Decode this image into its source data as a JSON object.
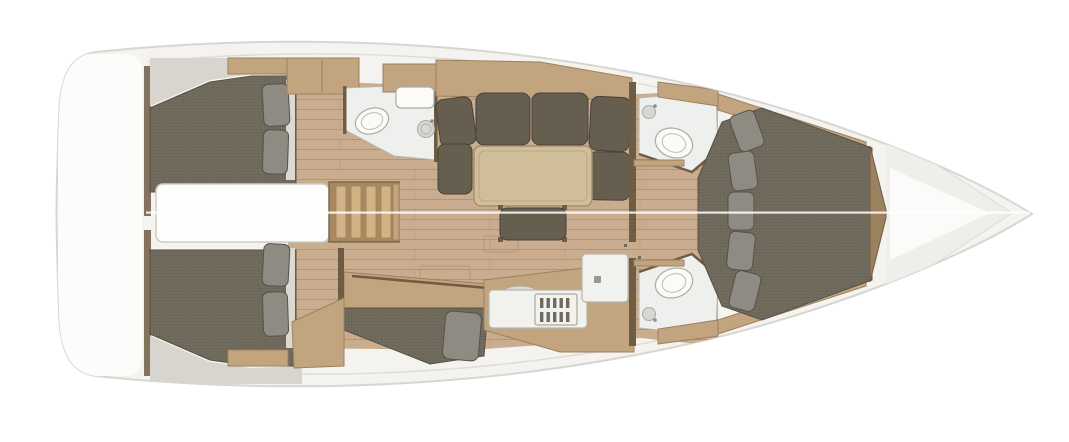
{
  "meta": {
    "description": "Top-view interior floor plan rendering of a monohull sailing yacht, bow pointing right",
    "image_type": "3D rendered boat layout plan",
    "orientation": "bow right, port side at top"
  },
  "colors": {
    "page_bg": "#ffffff",
    "hull_fill": "#f4f3f0",
    "hull_outline": "#d8d6d1",
    "deck_line": "#dedcd6",
    "transom": "#fcfcfa",
    "ceiling": "#d8d5cf",
    "floor": "#c9ad8e",
    "floor_seam": "#b2947a",
    "wood": "#c2a47f",
    "wood_dark": "#9c815f",
    "wood_deep": "#6e5c44",
    "stair_tread": "#d2b185",
    "mattress": "#6f695b",
    "mattress_edge": "#565145",
    "cushion": "#665f50",
    "cushion_edge": "#46413a",
    "pillow": "#8e8c82",
    "pillow_edge": "#55524a",
    "sheet": "#ded9d0",
    "table": "#d0bd9a",
    "table_edge": "#a68e6a",
    "counter": "#f1f1ee",
    "counter_edge": "#b8b5af",
    "head_floor": "#eef0ee",
    "fixture": "#fbfbf9",
    "fixture_edge": "#adaba5",
    "fixture_gray": "#d8d7d3",
    "burner": "#6f6a60",
    "engine_box": "#fdfdfc",
    "engine_edge": "#cfcdc8",
    "bow_deck": "#efeeea",
    "bow_highlight": "#fbfbf9",
    "seam": "#ffffff"
  },
  "layout": {
    "hull": {
      "label": "Yacht hull, top view, bow to the right"
    },
    "transom": {
      "label": "Stern transom and swim platform"
    },
    "aft_cabin_port": {
      "label": "Aft cabin, port side",
      "fixtures": "double berth, two pillows, shelf locker"
    },
    "aft_cabin_starboard": {
      "label": "Aft cabin, starboard side",
      "fixtures": "double berth, two pillows, shelf locker"
    },
    "engine_compartment": {
      "label": "Engine compartment between aft cabins"
    },
    "companionway": {
      "label": "Companionway steps",
      "fixtures": "four wooden treads"
    },
    "aft_head": {
      "label": "Aft head bathroom, port side",
      "fixtures": "toilet, round washbasin, vanity with sink"
    },
    "salon": {
      "label": "Salon with U-shaped settee, port side",
      "fixtures": "sofa back cushions, chaise seat, dining table, movable bench"
    },
    "starboard_settee": {
      "label": "Starboard lounge settee",
      "fixtures": "cushioned daybed, pillow, wood platform"
    },
    "galley": {
      "label": "Galley, starboard side",
      "fixtures": "worktop with sink, stove with burner grates, second worktop"
    },
    "forward_head_port": {
      "label": "Forward head, port side",
      "fixtures": "toilet, washbasin, locker"
    },
    "forward_head_starboard": {
      "label": "Forward shower head, starboard side",
      "fixtures": "toilet, washbasin, locker"
    },
    "forward_cabin": {
      "label": "Owner cabin forward",
      "fixtures": "island double berth, five pillows, side shelves, footboard"
    },
    "bow_locker": {
      "label": "Bow anchor locker"
    }
  }
}
